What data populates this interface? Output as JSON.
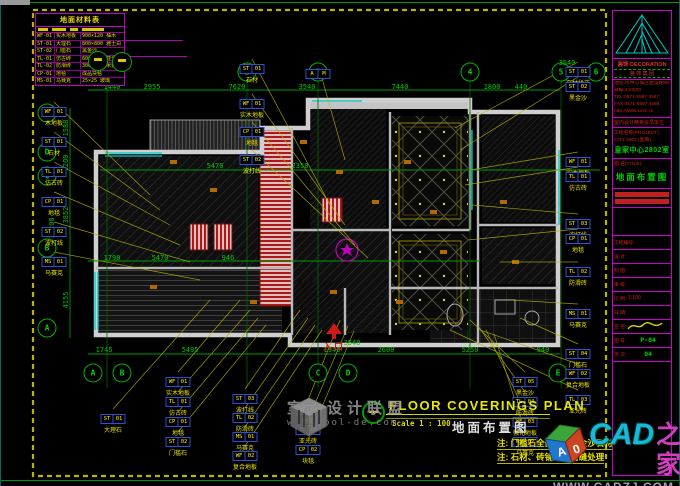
{
  "colors": {
    "dim_green": "#00c800",
    "leader_yellow": "#b9b400",
    "magenta": "#cc00cc",
    "cyan": "#00c9c9",
    "callout_blue": "#2d4fd0",
    "entrance_red": "#d01818",
    "title_yellow": "#e8e800"
  },
  "legend": {
    "title": "地面材料表",
    "rows": [
      {
        "code": "WF-01",
        "name": "实木地板",
        "spec": "900×120 柚木"
      },
      {
        "code": "ST-01",
        "name": "大理石",
        "spec": "800×800 雅士白"
      },
      {
        "code": "ST-02",
        "name": "门槛石",
        "spec": "黑金沙"
      },
      {
        "code": "TL-01",
        "name": "仿古砖",
        "spec": "600×600 亚光"
      },
      {
        "code": "TL-02",
        "name": "防滑砖",
        "spec": "300×300 米黄"
      },
      {
        "code": "CP-01",
        "name": "地毯",
        "spec": "成品块毯"
      },
      {
        "code": "MS-01",
        "name": "马赛克",
        "spec": "25×25 玻璃"
      }
    ]
  },
  "titleblock": {
    "company": "装饰 DECORATION",
    "company_sub": "装 饰 集 团",
    "contact_lines": [
      "地址:市中心城区建设路88号",
      "邮编:310000",
      "TEL:0571-8567 4567",
      "FAX:0571-8567 4568",
      "http://www.xxxx.cn"
    ],
    "org_line": "室内设计精英会员单位",
    "project_label": "工程名称(PROJECT):",
    "project_sub": "CITY 2802 (图审)",
    "project_name": "皇家中心2802室",
    "title_label": "图 名(TITLE):",
    "drawing_title": "地面布置图",
    "rows": [
      {
        "l": "工程编号:",
        "v": ""
      },
      {
        "l": "设 计:",
        "v": ""
      },
      {
        "l": "制 图:",
        "v": ""
      },
      {
        "l": "审 核:",
        "v": ""
      },
      {
        "l": "比 例:",
        "v": "1:100"
      },
      {
        "l": "日 期:",
        "v": ""
      },
      {
        "l": "签 名:",
        "v": "",
        "sig": true
      },
      {
        "l": "图 号:",
        "v": "P-04",
        "green": true
      },
      {
        "l": "页 次:",
        "v": "04",
        "green": true
      }
    ]
  },
  "plan": {
    "entrance": "入口",
    "axes_top": [
      {
        "x": 107,
        "t": "1"
      },
      {
        "x": 247,
        "t": "2"
      },
      {
        "x": 318,
        "t": "3"
      },
      {
        "x": 470,
        "t": "4"
      },
      {
        "x": 561,
        "t": "5"
      },
      {
        "x": 596,
        "t": "6"
      }
    ],
    "axes_left": [
      {
        "y": 113,
        "t": "E"
      },
      {
        "y": 152,
        "t": "D"
      },
      {
        "y": 176,
        "t": "C"
      },
      {
        "y": 248,
        "t": "B"
      },
      {
        "y": 328,
        "t": "A"
      }
    ],
    "axes_bottom": [
      {
        "x": 93,
        "t": "A"
      },
      {
        "x": 122,
        "t": "B"
      },
      {
        "x": 318,
        "t": "C"
      },
      {
        "x": 348,
        "t": "D"
      },
      {
        "x": 558,
        "t": "E"
      }
    ],
    "dims_top": [
      {
        "x": 112,
        "y": 87,
        "t": "1440"
      },
      {
        "x": 152,
        "y": 87,
        "t": "2955"
      },
      {
        "x": 237,
        "y": 87,
        "t": "7620"
      },
      {
        "x": 307,
        "y": 87,
        "t": "3540"
      },
      {
        "x": 400,
        "y": 87,
        "t": "7440"
      },
      {
        "x": 492,
        "y": 87,
        "t": "1800"
      },
      {
        "x": 521,
        "y": 87,
        "t": "440"
      }
    ],
    "dims_bottom": [
      {
        "x": 104,
        "y": 350,
        "t": "1745"
      },
      {
        "x": 190,
        "y": 350,
        "t": "5495"
      },
      {
        "x": 332,
        "y": 350,
        "t": "1940"
      },
      {
        "x": 386,
        "y": 350,
        "t": "2600"
      },
      {
        "x": 470,
        "y": 350,
        "t": "5250"
      },
      {
        "x": 543,
        "y": 350,
        "t": "940"
      }
    ],
    "dims_left": [
      {
        "x": 66,
        "y": 128,
        "t": "1588",
        "rot": true
      },
      {
        "x": 66,
        "y": 163,
        "t": "1200",
        "rot": true
      },
      {
        "x": 66,
        "y": 215,
        "t": "3852",
        "rot": true
      },
      {
        "x": 66,
        "y": 300,
        "t": "4155",
        "rot": true
      },
      {
        "x": 52,
        "y": 228,
        "t": "10200",
        "rot": true
      }
    ],
    "dims_inner": [
      {
        "x": 567,
        "y": 63,
        "t": "3540"
      },
      {
        "x": 215,
        "y": 166,
        "t": "5470"
      },
      {
        "x": 300,
        "y": 166,
        "t": "2350"
      },
      {
        "x": 112,
        "y": 258,
        "t": "1790"
      },
      {
        "x": 160,
        "y": 258,
        "t": "5470"
      },
      {
        "x": 228,
        "y": 258,
        "t": "946"
      },
      {
        "x": 352,
        "y": 343,
        "t": "3540"
      }
    ],
    "callouts": [
      {
        "x": 578,
        "y": 58,
        "c1": "ST",
        "c2": "01",
        "label": "石材拼花",
        "lx": 455,
        "ly": 128
      },
      {
        "x": 578,
        "y": 73,
        "c1": "ST",
        "c2": "02",
        "label": "黑金沙",
        "lx": 460,
        "ly": 150
      },
      {
        "x": 578,
        "y": 148,
        "c1": "WF",
        "c2": "01",
        "label": "实木地板",
        "lx": 470,
        "ly": 170
      },
      {
        "x": 578,
        "y": 163,
        "c1": "TL",
        "c2": "01",
        "label": "仿古砖",
        "lx": 465,
        "ly": 185
      },
      {
        "x": 578,
        "y": 210,
        "c1": "ST",
        "c2": "03",
        "label": "波打线",
        "lx": 472,
        "ly": 205
      },
      {
        "x": 578,
        "y": 225,
        "c1": "CP",
        "c2": "01",
        "label": "地毯",
        "lx": 468,
        "ly": 240
      },
      {
        "x": 578,
        "y": 258,
        "c1": "TL",
        "c2": "02",
        "label": "防滑砖",
        "lx": 500,
        "ly": 262
      },
      {
        "x": 578,
        "y": 300,
        "c1": "MS",
        "c2": "01",
        "label": "马赛克",
        "lx": 510,
        "ly": 300
      },
      {
        "x": 578,
        "y": 340,
        "c1": "ST",
        "c2": "04",
        "label": "门槛石",
        "lx": 520,
        "ly": 318
      },
      {
        "x": 578,
        "y": 360,
        "c1": "WF",
        "c2": "02",
        "label": "复合地板",
        "lx": 480,
        "ly": 330
      },
      {
        "x": 578,
        "y": 386,
        "c1": "TL",
        "c2": "03",
        "label": "亚光砖",
        "lx": 450,
        "ly": 330
      },
      {
        "x": 252,
        "y": 55,
        "c1": "ST",
        "c2": "01",
        "label": "石材",
        "lx": 330,
        "ly": 205
      },
      {
        "x": 252,
        "y": 90,
        "c1": "WF",
        "c2": "01",
        "label": "实木地板",
        "lx": 345,
        "ly": 225
      },
      {
        "x": 252,
        "y": 118,
        "c1": "CP",
        "c2": "01",
        "label": "地毯",
        "lx": 355,
        "ly": 245
      },
      {
        "x": 252,
        "y": 146,
        "c1": "ST",
        "c2": "02",
        "label": "波打线",
        "lx": 368,
        "ly": 258
      },
      {
        "x": 318,
        "y": 60,
        "c1": "A",
        "c2": "M",
        "label": "",
        "lx": 345,
        "ly": 160
      },
      {
        "x": 54,
        "y": 98,
        "c1": "WF",
        "c2": "01",
        "label": "木地板",
        "lx": 150,
        "ly": 195
      },
      {
        "x": 54,
        "y": 128,
        "c1": "ST",
        "c2": "01",
        "label": "石材",
        "lx": 160,
        "ly": 210
      },
      {
        "x": 54,
        "y": 158,
        "c1": "TL",
        "c2": "01",
        "label": "仿古砖",
        "lx": 170,
        "ly": 225
      },
      {
        "x": 54,
        "y": 188,
        "c1": "CP",
        "c2": "01",
        "label": "地毯",
        "lx": 180,
        "ly": 245
      },
      {
        "x": 54,
        "y": 218,
        "c1": "ST",
        "c2": "02",
        "label": "波打线",
        "lx": 190,
        "ly": 262
      },
      {
        "x": 54,
        "y": 248,
        "c1": "MS",
        "c2": "01",
        "label": "马赛克",
        "lx": 200,
        "ly": 280
      },
      {
        "x": 113,
        "y": 405,
        "c1": "ST",
        "c2": "01",
        "label": "大理石",
        "lx": 210,
        "ly": 300
      },
      {
        "x": 178,
        "y": 368,
        "c1": "WF",
        "c2": "01",
        "label": "实木地板",
        "lx": 240,
        "ly": 300
      },
      {
        "x": 178,
        "y": 388,
        "c1": "TL",
        "c2": "01",
        "label": "仿古砖",
        "lx": 250,
        "ly": 310
      },
      {
        "x": 178,
        "y": 408,
        "c1": "CP",
        "c2": "01",
        "label": "地毯",
        "lx": 258,
        "ly": 318
      },
      {
        "x": 178,
        "y": 428,
        "c1": "ST",
        "c2": "02",
        "label": "门槛石",
        "lx": 266,
        "ly": 325
      },
      {
        "x": 245,
        "y": 385,
        "c1": "ST",
        "c2": "03",
        "label": "波打线",
        "lx": 300,
        "ly": 310
      },
      {
        "x": 245,
        "y": 404,
        "c1": "TL",
        "c2": "02",
        "label": "防滑砖",
        "lx": 308,
        "ly": 318
      },
      {
        "x": 245,
        "y": 423,
        "c1": "MS",
        "c2": "01",
        "label": "马赛克",
        "lx": 315,
        "ly": 325
      },
      {
        "x": 245,
        "y": 442,
        "c1": "WF",
        "c2": "02",
        "label": "复合地板",
        "lx": 322,
        "ly": 330
      },
      {
        "x": 308,
        "y": 396,
        "c1": "ST",
        "c2": "04",
        "label": "拼花",
        "lx": 340,
        "ly": 320
      },
      {
        "x": 308,
        "y": 416,
        "c1": "TL",
        "c2": "03",
        "label": "亚光砖",
        "lx": 348,
        "ly": 326
      },
      {
        "x": 308,
        "y": 436,
        "c1": "CP",
        "c2": "02",
        "label": "块毯",
        "lx": 354,
        "ly": 331
      },
      {
        "x": 525,
        "y": 368,
        "c1": "ST",
        "c2": "05",
        "label": "黑金沙",
        "lx": 470,
        "ly": 320
      },
      {
        "x": 525,
        "y": 388,
        "c1": "TL",
        "c2": "04",
        "label": "防滑砖",
        "lx": 478,
        "ly": 326
      },
      {
        "x": 525,
        "y": 408,
        "c1": "WF",
        "c2": "03",
        "label": "强化地板",
        "lx": 486,
        "ly": 330
      },
      {
        "x": 525,
        "y": 428,
        "c1": "MS",
        "c2": "02",
        "label": "马赛克",
        "lx": 494,
        "ly": 334
      }
    ]
  },
  "footer": {
    "title_en": "FLOOR COVERINGS PLAN",
    "scale": "Scale 1 : 100",
    "title_cn": "地面布置图",
    "notes": [
      "注: 门槛石全部采用黑金沙石材",
      "注: 石材、砖铺贴均留缝处理"
    ]
  },
  "watermarks": {
    "forum_name": "室内设计联盟",
    "forum_url": "www.cool-de.com",
    "cad_name_1": "CAD",
    "cad_name_2": "之家",
    "cad_url": "WWW.CADZJ.COM",
    "cube_a": "A",
    "cube_0": "0"
  }
}
